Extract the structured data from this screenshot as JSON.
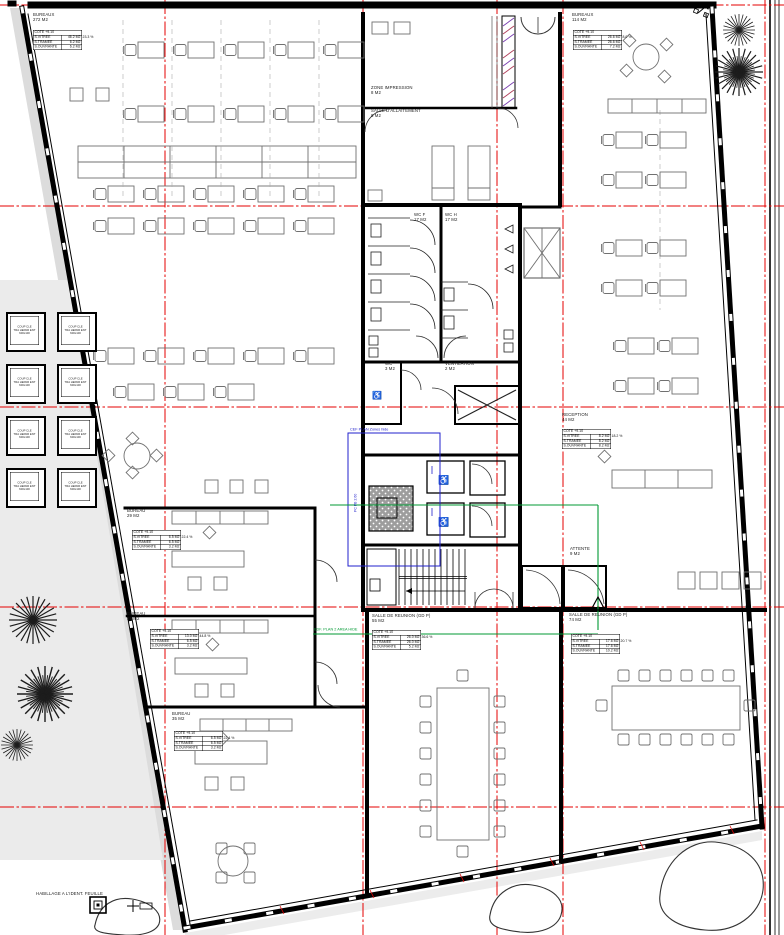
{
  "title": "Plan d'etage bureaux - niveau +9.10",
  "colors": {
    "axis_red": "#e60000",
    "annotation_green": "#009933",
    "annotation_blue": "#2222cc",
    "wall_black": "#000000",
    "furniture_gray": "#707070",
    "site_gray": "#ebebeb"
  },
  "annotations": {
    "blue_note": "CEF PLAN Zones hide",
    "green_note": "EDF. PLAN 2 AREA HIDE",
    "side_note": "PC PB 2.60",
    "finish_note": "HABILLAGE A L'IDENT. FEUILLE"
  },
  "skylight": {
    "lines": [
      [
        "COUP CLE"
      ],
      [
        "TRA HEPAR ENT"
      ],
      [
        "600x100"
      ]
    ]
  },
  "rooms": [
    {
      "name": "BUREAUX",
      "area": "272 M2",
      "table": {
        "header": "COTE +9.10",
        "rows": [
          [
            "S.VITREE",
            "46.2 M2",
            "23.3 %"
          ],
          [
            "S.TRAMEE",
            "6.2 M2"
          ],
          [
            "S.OUVRANTE",
            "6.2 M2"
          ]
        ]
      }
    },
    {
      "name": "BUREAUX",
      "area": "114 M2",
      "table": {
        "header": "COTE +9.10",
        "rows": [
          [
            "S.VITREE",
            "26.6 M2",
            "8.0 %"
          ],
          [
            "S.TRAMEE",
            "26.6 M2"
          ],
          [
            "S.OUVRANTE",
            "7.2 M2"
          ]
        ]
      }
    },
    {
      "name": "ZONE IMPRESSION",
      "area": "8 M2"
    },
    {
      "name": "SALLE D'ALLAITEMENT",
      "area": "8 M2"
    },
    {
      "name": "WC F",
      "area": "17 M2"
    },
    {
      "name": "WC H",
      "area": "17 M2"
    },
    {
      "name": "WC",
      "area": "3 M2"
    },
    {
      "name": "VENTILATION",
      "area": "2 M2"
    },
    {
      "name": "RECEPTION",
      "area": "44 M2",
      "table": {
        "header": "COTE +9.10",
        "rows": [
          [
            "S.VITREE",
            "8.2 M2",
            "18.2 %"
          ],
          [
            "S.TRAMEE",
            "8.2 M2"
          ],
          [
            "S.OUVRANTE",
            "8.2 M2"
          ]
        ]
      }
    },
    {
      "name": "ATTENTE",
      "area": "9 M2"
    },
    {
      "name": "SALLE DE REUNION (GD P)",
      "area": "55 M2",
      "table": {
        "header": "COTE +9.10",
        "rows": [
          [
            "S.VITREE",
            "26.0 M2",
            "36.6 %"
          ],
          [
            "S.TRAMEE",
            "26.0 M2"
          ],
          [
            "S.OUVRANTE",
            "5.2 M2"
          ]
        ]
      }
    },
    {
      "name": "SALLE DE REUNION (GD P)",
      "area": "74 M2",
      "table": {
        "header": "COTE +9.10",
        "rows": [
          [
            "S.VITREE",
            "17.6 M2",
            "20.7 %"
          ],
          [
            "S.TRAMEE",
            "17.6 M2"
          ],
          [
            "S.OUVRANTE",
            "10.2 M2"
          ]
        ]
      }
    },
    {
      "name": "BUREAU",
      "area": "29 M2",
      "table": {
        "header": "COTE +9.10",
        "rows": [
          [
            "S.VITREE",
            "6.5 M2",
            "22.4 %"
          ],
          [
            "S.TRAMEE",
            "6.5 M2"
          ],
          [
            "S.OUVRANTE",
            "3.2 M2"
          ]
        ]
      }
    },
    {
      "name": "BUREAU",
      "area": "29 M2",
      "table": {
        "header": "COTE +9.10",
        "rows": [
          [
            "S.VITREE",
            "13.0 M2",
            "44.8 %"
          ],
          [
            "S.TRAMEE",
            "6.5 M2"
          ],
          [
            "S.OUVRANTE",
            "3.2 M2"
          ]
        ]
      }
    },
    {
      "name": "BUREAU",
      "area": "35 M2",
      "table": {
        "header": "COTE +9.10",
        "rows": [
          [
            "S.VITREE",
            "6.5 M2",
            "22.4 %"
          ],
          [
            "S.TRAMEE",
            "6.5 M2"
          ],
          [
            "S.OUVRANTE",
            "3.2 M2"
          ]
        ]
      }
    }
  ]
}
